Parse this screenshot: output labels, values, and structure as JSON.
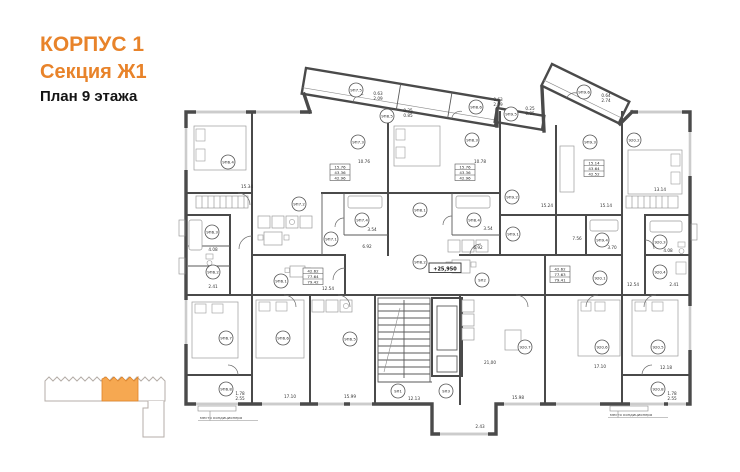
{
  "header": {
    "building": "КОРПУС 1",
    "section": "Секция Ж1",
    "floor": "План 9 этажа"
  },
  "colors": {
    "accent": "#E8832A",
    "minimap_highlight": "#F6A851",
    "plan_line": "#4a4a4a"
  },
  "plan": {
    "level_mark": "+25,950",
    "ac_note_left": "место кондиционера",
    "ac_note_right": "место кондиционера",
    "rooms": [
      {
        "label": "9П6.4"
      },
      {
        "label": "9П6.3"
      },
      {
        "label": "9П6.2"
      },
      {
        "label": "9П6.1"
      },
      {
        "label": "9П6.7"
      },
      {
        "label": "9П6.6"
      },
      {
        "label": "9П6.5"
      },
      {
        "label": "9П6.8"
      },
      {
        "label": "9П7.5"
      },
      {
        "label": "9П8.6"
      },
      {
        "label": "9П8.5"
      },
      {
        "label": "9П9.5"
      },
      {
        "label": "9П9.6"
      },
      {
        "label": "9П7.3"
      },
      {
        "label": "9П7.2"
      },
      {
        "label": "9П7.1"
      },
      {
        "label": "9П7.4"
      },
      {
        "label": "9П8.3"
      },
      {
        "label": "9П8.4"
      },
      {
        "label": "9П8.1"
      },
      {
        "label": "9П8.2"
      },
      {
        "label": "9П9.2"
      },
      {
        "label": "9П9.1"
      },
      {
        "label": "9П9.3"
      },
      {
        "label": "9П9.4"
      },
      {
        "label": "920.2"
      },
      {
        "label": "920.3"
      },
      {
        "label": "920.4"
      },
      {
        "label": "920.1"
      },
      {
        "label": "9Л2"
      },
      {
        "label": "920.7"
      },
      {
        "label": "920.6"
      },
      {
        "label": "920.5"
      },
      {
        "label": "920.8"
      },
      {
        "label": "9Л1"
      },
      {
        "label": "9Л3"
      }
    ],
    "dims": [
      "15.34",
      "10.76",
      "3.54",
      "6.92",
      "4.08",
      "2.41",
      "12.54",
      "17.10",
      "15.99",
      "1.78",
      "2.55",
      "0.63",
      "2.09",
      "0.25",
      "0.85",
      "0.63",
      "2.09",
      "0.25",
      "0.85",
      "0.64",
      "2.74",
      "10.78",
      "3.54",
      "6.92",
      "7.56",
      "15.24",
      "15.14",
      "13.14",
      "4.08",
      "2.41",
      "12.54",
      "21,00",
      "12.13",
      "2.43",
      "15.98",
      "17.10",
      "12.18",
      "1.78",
      "2.55",
      "3.70"
    ],
    "area_tables": [
      {
        "rows": [
          "15.76",
          "43.36",
          "42.96"
        ]
      },
      {
        "rows": [
          "42.62",
          "77.64",
          "79.42"
        ]
      },
      {
        "rows": [
          "15.76",
          "43.36",
          "42.96"
        ]
      },
      {
        "rows": [
          "15.14",
          "43.64",
          "42.52"
        ]
      },
      {
        "rows": [
          "42.62",
          "77.63",
          "79.41"
        ]
      }
    ]
  }
}
